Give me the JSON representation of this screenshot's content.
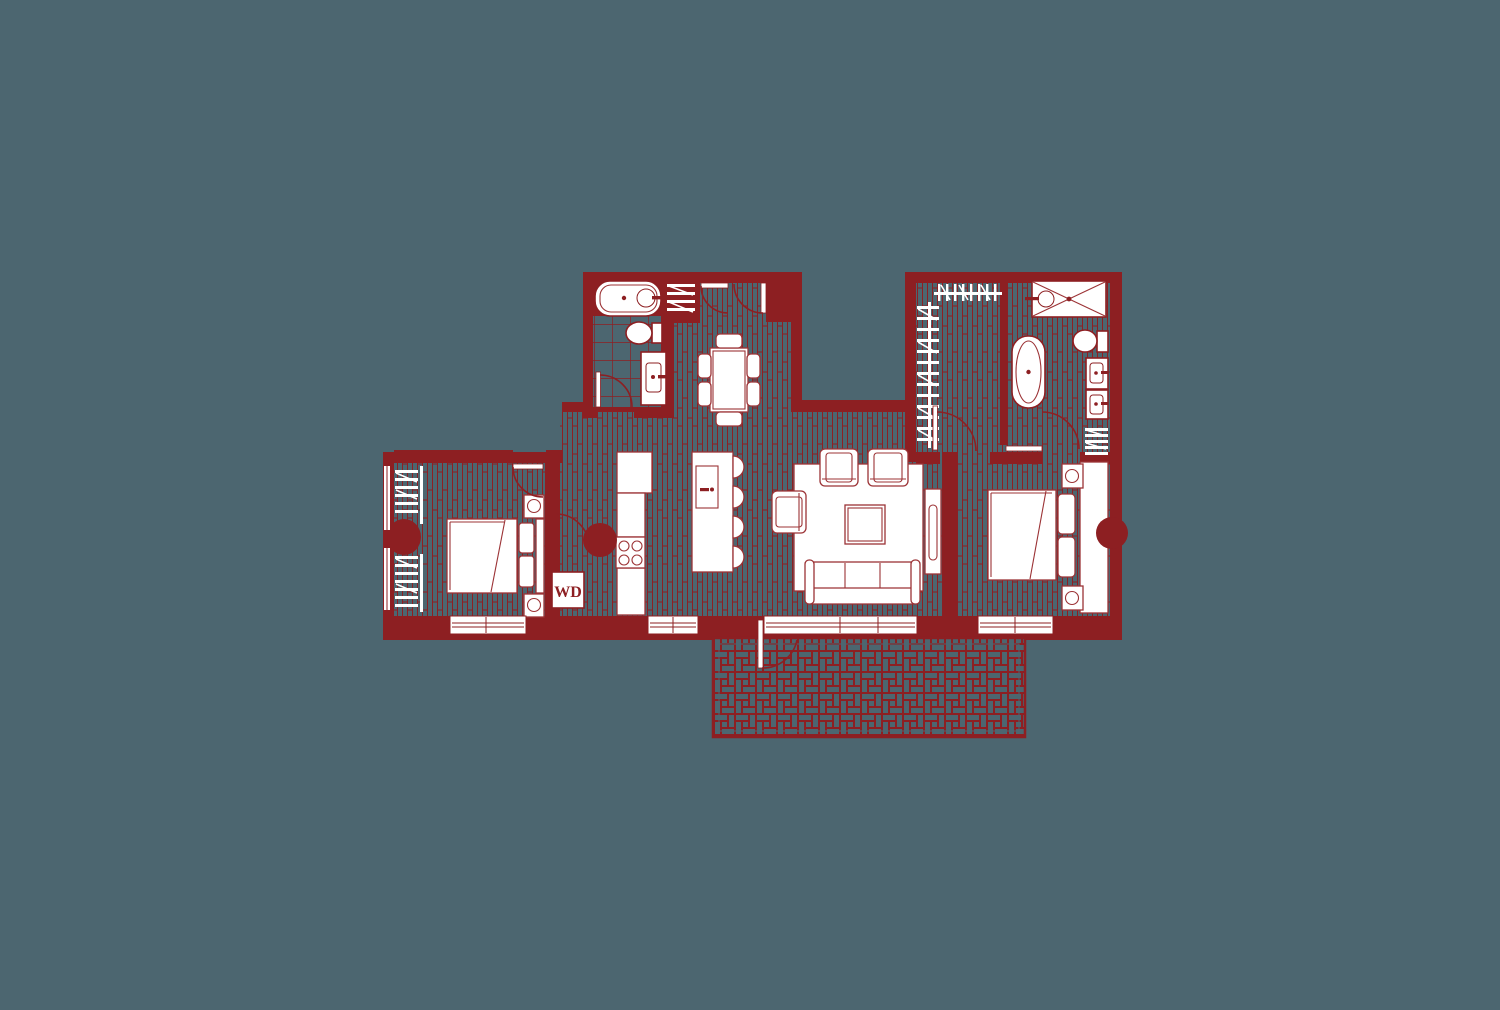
{
  "title": "Two-bedroom apartment floor plan with terrace",
  "labels": {
    "washer_dryer": "WD"
  },
  "colors": {
    "bg": "#4C6670",
    "wall": "#8D1F22",
    "fur": "#9C3336",
    "white": "#FFFFFF"
  },
  "rooms": [
    {
      "name": "bathroom",
      "fixtures": [
        "bathtub",
        "toilet",
        "vanity-sink",
        "door"
      ]
    },
    {
      "name": "entry-hall",
      "fixtures": [
        "entry-double-door",
        "coat-closet",
        "dining-table",
        "dining-chairs"
      ]
    },
    {
      "name": "bedroom-2",
      "fixtures": [
        "closet-hangers",
        "double-bed",
        "nightstand-lamps",
        "window",
        "door",
        "column"
      ]
    },
    {
      "name": "kitchen",
      "fixtures": [
        "counter",
        "cooktop-4-burner",
        "island-with-sink",
        "bar-stools",
        "washer-dryer-closet",
        "column"
      ]
    },
    {
      "name": "living-room",
      "fixtures": [
        "area-rug",
        "armchairs",
        "coffee-table",
        "sofa",
        "tv-console",
        "terrace-door",
        "windows"
      ]
    },
    {
      "name": "walk-in-closet",
      "fixtures": [
        "hanging-rods",
        "door"
      ]
    },
    {
      "name": "master-bathroom",
      "fixtures": [
        "walk-in-shower",
        "freestanding-tub",
        "toilet",
        "double-vanity",
        "towel-shelf",
        "door"
      ]
    },
    {
      "name": "master-bedroom",
      "fixtures": [
        "double-bed",
        "headboard-wall",
        "nightstand-lamps",
        "window",
        "column"
      ]
    },
    {
      "name": "terrace",
      "fixtures": [
        "lattice-paving"
      ]
    }
  ]
}
